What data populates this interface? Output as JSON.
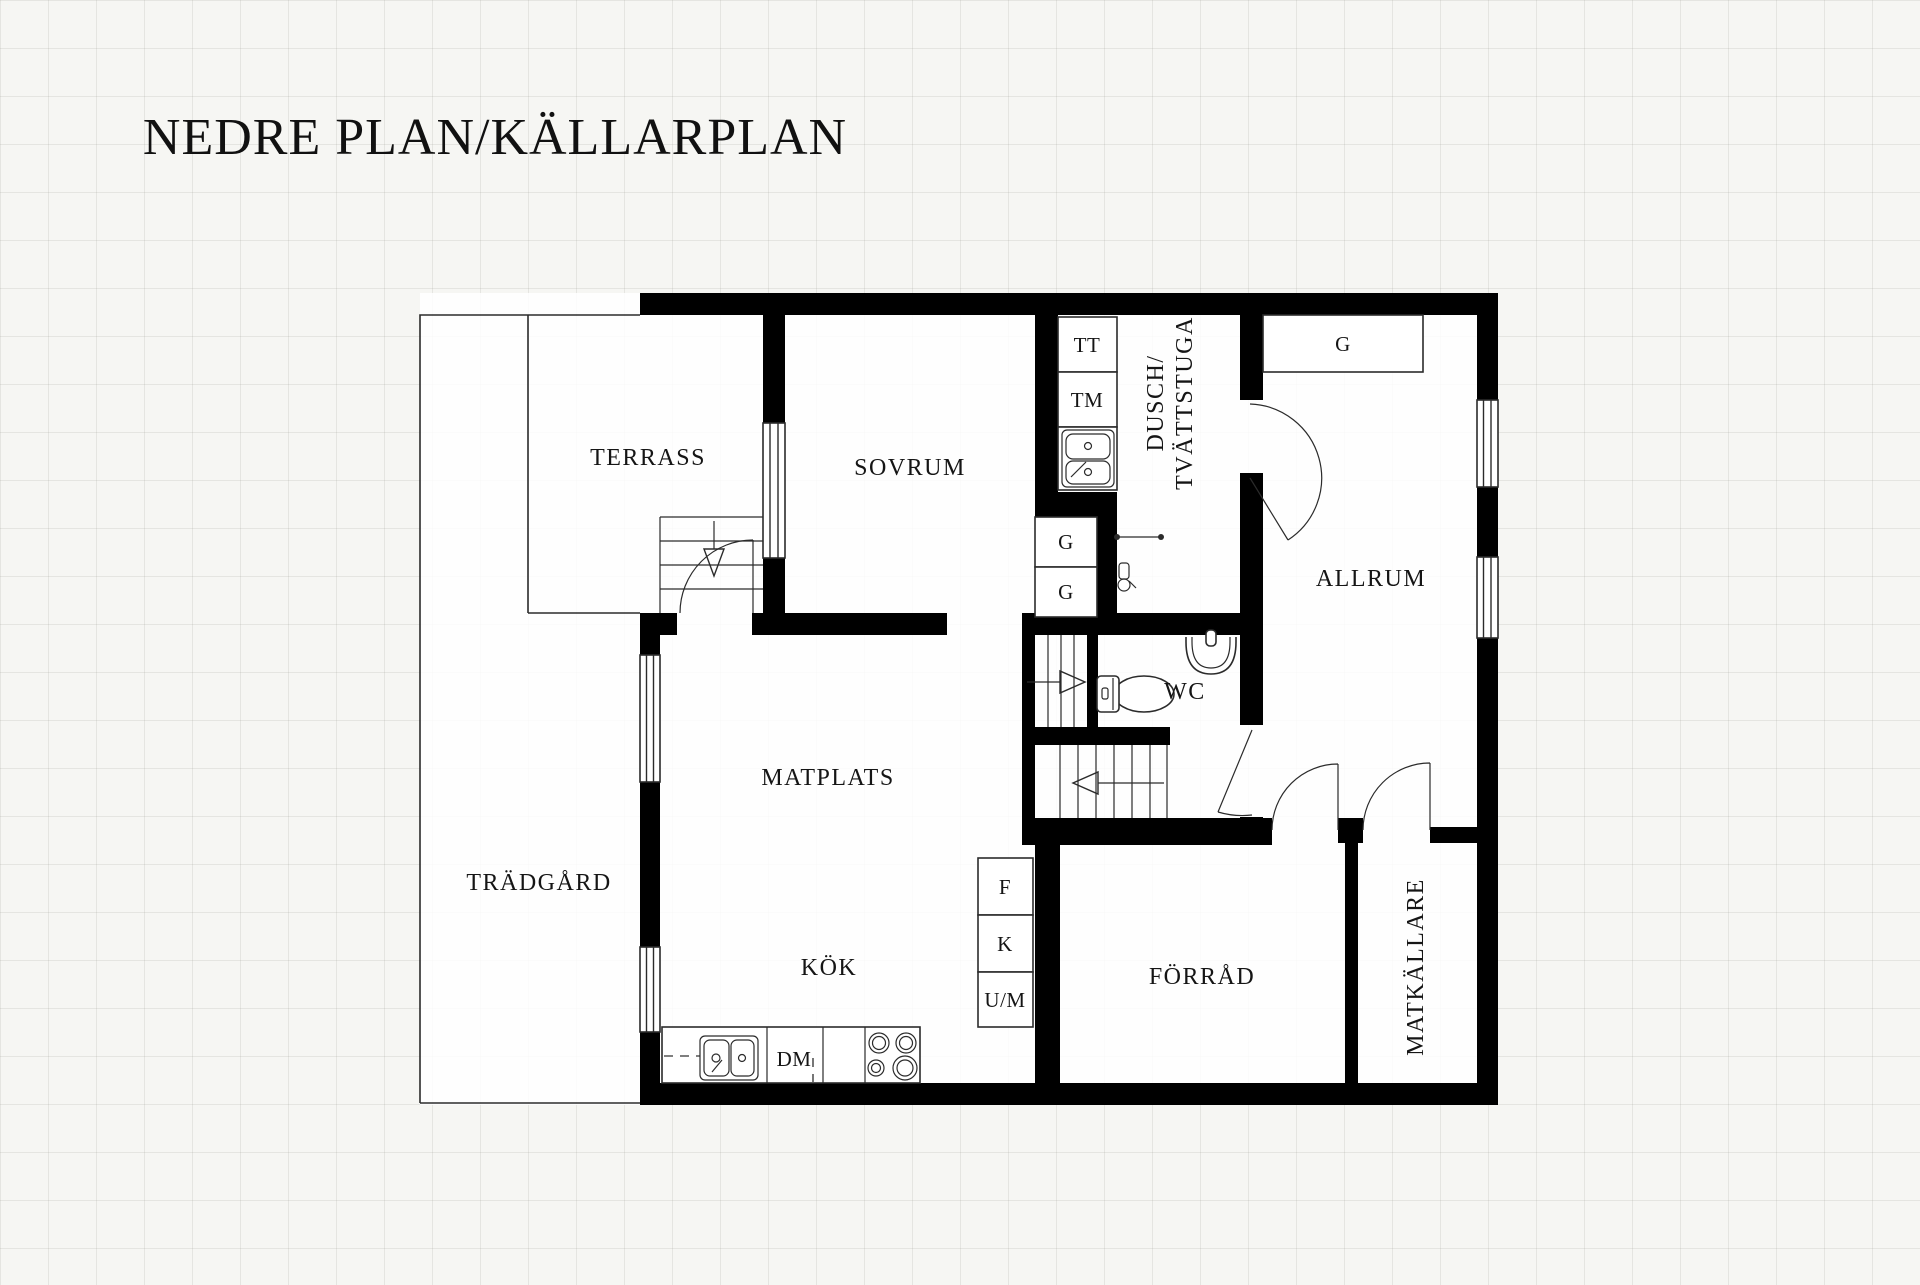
{
  "title": "NEDRE PLAN/KÄLLARPLAN",
  "rooms": {
    "terrass": {
      "label": "TERRASS"
    },
    "sovrum": {
      "label": "SOVRUM"
    },
    "dusch_tvattstuga": {
      "line1": "DUSCH/",
      "line2": "TVÄTTSTUGA"
    },
    "allrum": {
      "label": "ALLRUM"
    },
    "matplats": {
      "label": "MATPLATS"
    },
    "wc": {
      "label": "WC"
    },
    "tradgard": {
      "label": "TRÄDGÅRD"
    },
    "kok": {
      "label": "KÖK"
    },
    "forrad": {
      "label": "FÖRRÅD"
    },
    "matkallare": {
      "label": "MATKÄLLARE"
    }
  },
  "fixtures": {
    "tt": "TT",
    "tm": "TM",
    "g_allrum": "G",
    "g_hall_top": "G",
    "g_hall_bottom": "G",
    "f": "F",
    "k": "K",
    "um": "U/M",
    "dm": "DM"
  },
  "colors": {
    "wall": "#000000",
    "line": "#2b2b2b",
    "background": "#f6f6f3",
    "room_fill": "#ffffff"
  }
}
